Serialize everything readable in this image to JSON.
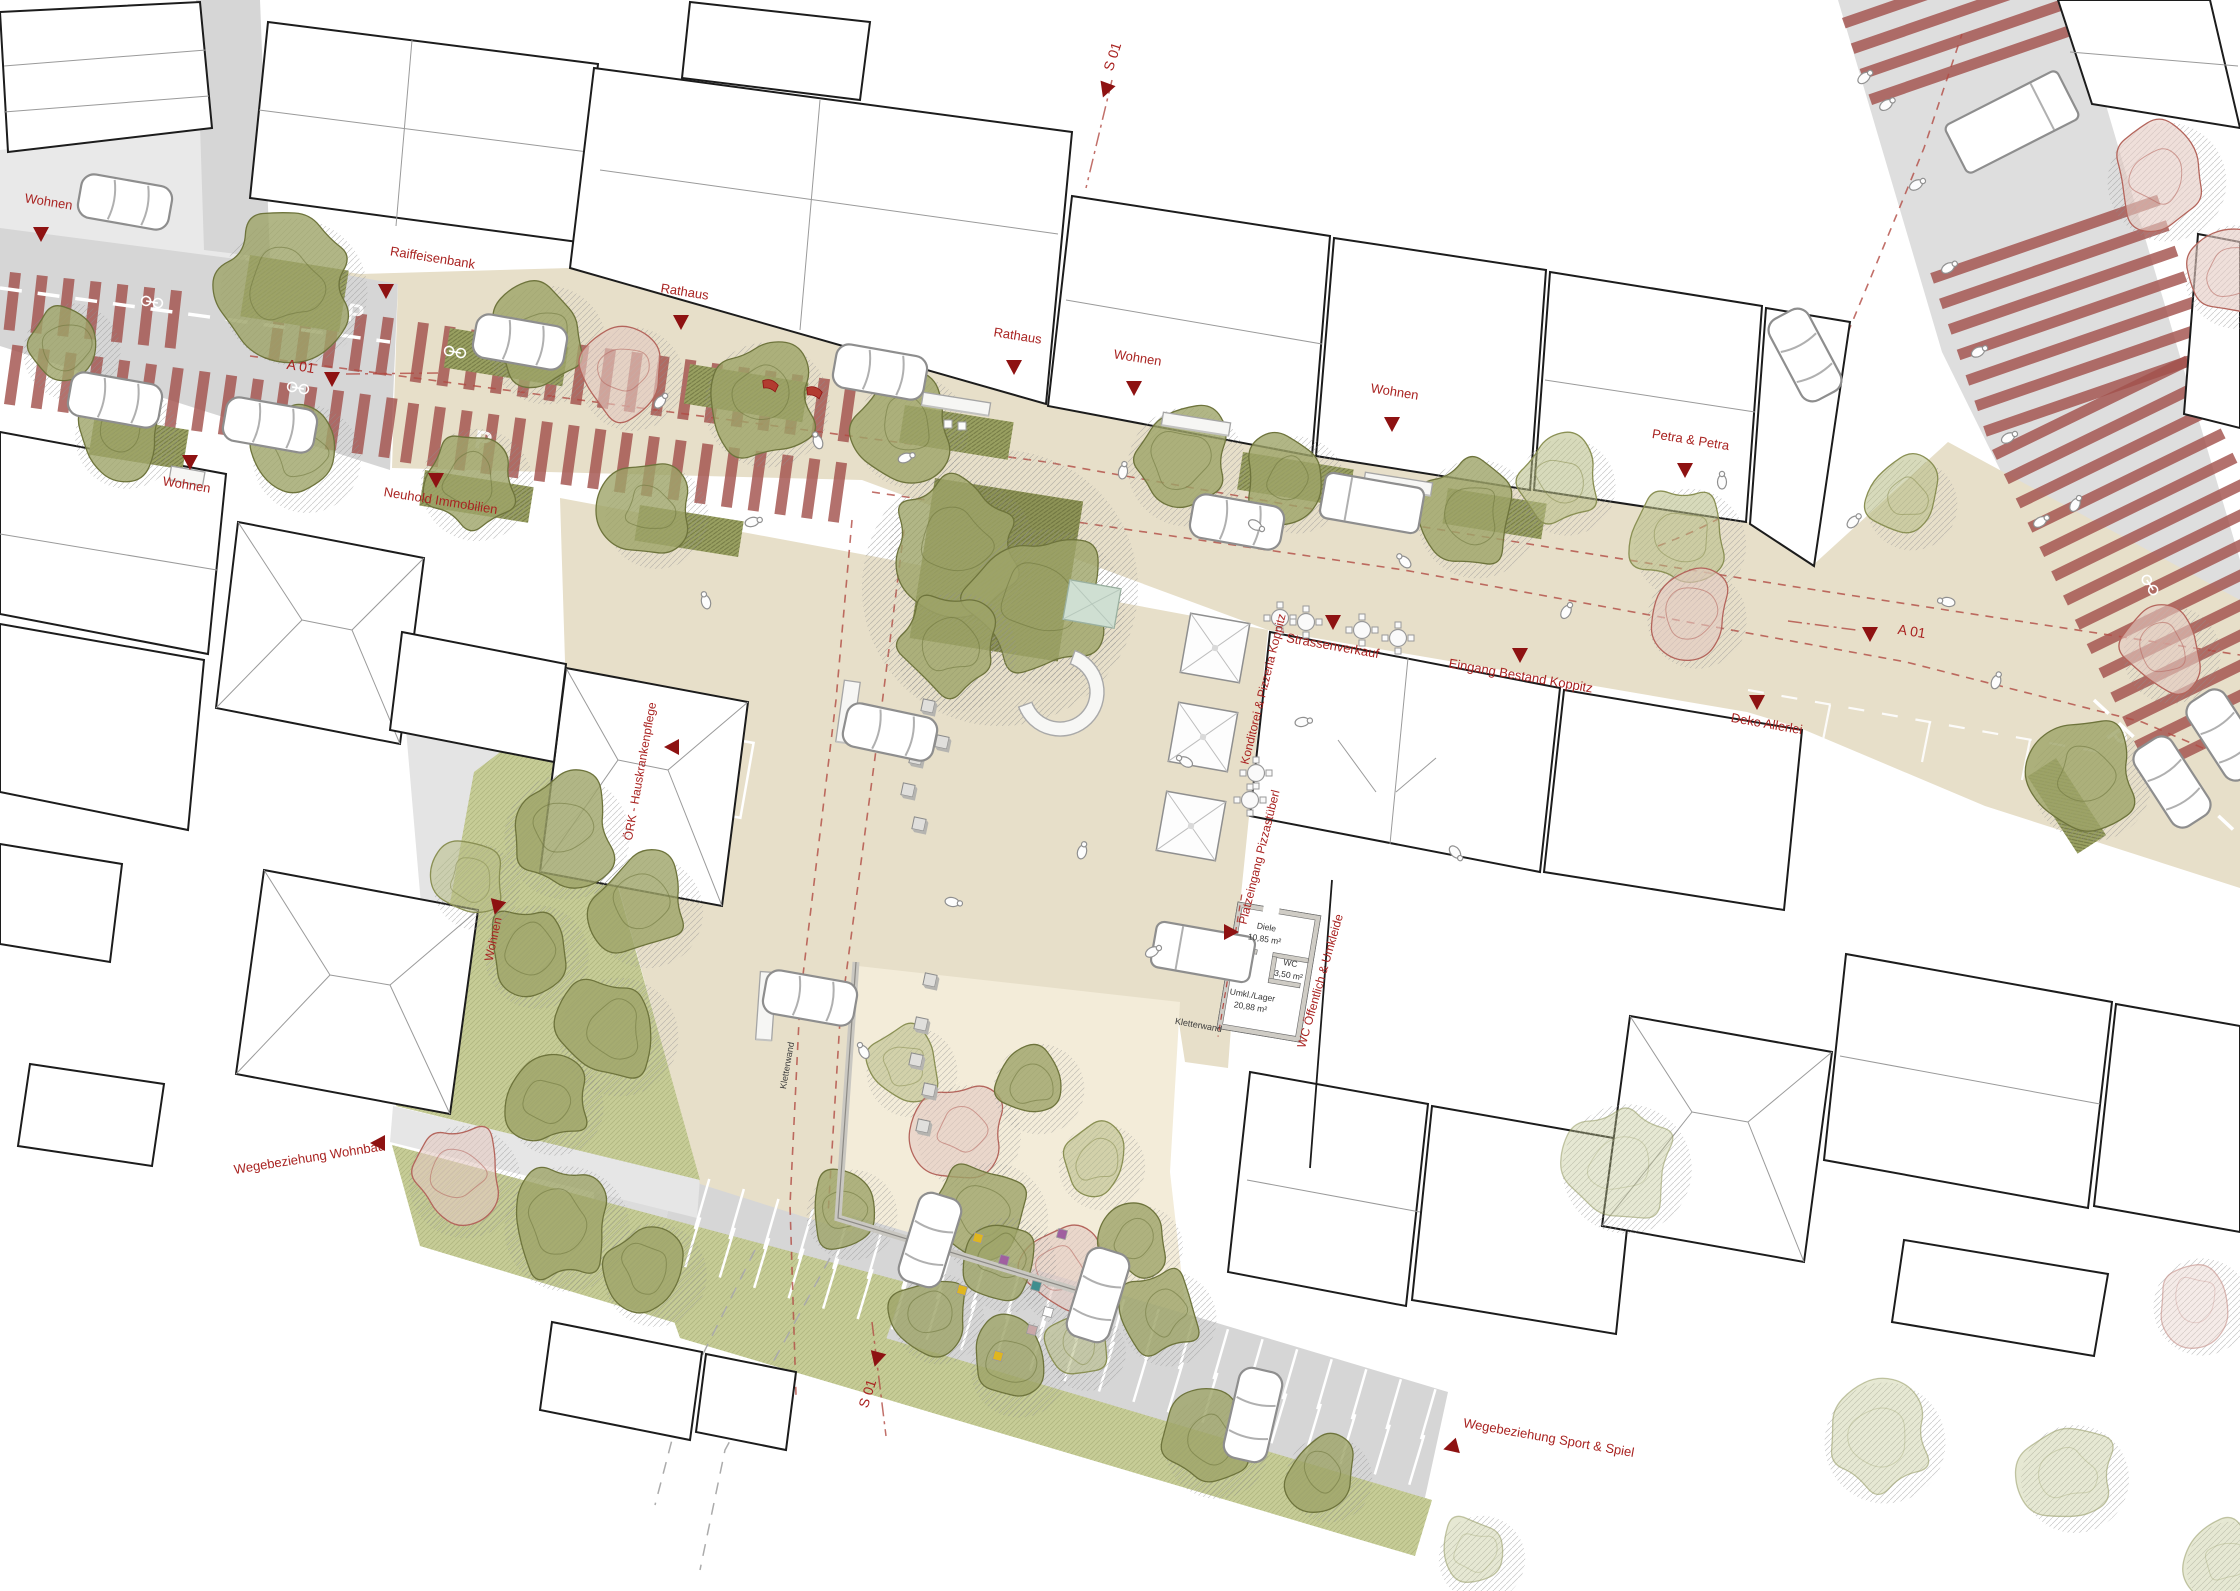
{
  "colors": {
    "background": "#ffffff",
    "plaza": "#e7dfc9",
    "street": "#d6d6d6",
    "street_light": "#e9e9e9",
    "building_fill": "#ffffff",
    "building_stroke": "#1c1c1c",
    "roof_line": "#9a9a9a",
    "stripe_red": "#a2524d",
    "label_red": "#a92321",
    "marker_red": "#8e1212",
    "guide_dash_red": "#b24b44",
    "tree_olive": "#6e743c",
    "tree_olive_light": "#8a9054",
    "tree_pink": "#b4655c",
    "lawn": "#c6cc96",
    "playground": "#f3ecd9",
    "wall_gray": "#c6c4be",
    "road_marking": "#ffffff",
    "black_label": "#3c3c3c"
  },
  "plan_labels": [
    {
      "id": "wohnen-top-left",
      "text": "Wohnen",
      "x": 48,
      "y": 206,
      "rot": 9,
      "size": 13,
      "color": "red",
      "marker": {
        "x": 41,
        "y": 233,
        "rot": 0
      }
    },
    {
      "id": "raiffeisenbank",
      "text": "Raiffeisenbank",
      "x": 432,
      "y": 262,
      "rot": 9,
      "size": 13,
      "color": "red",
      "marker": {
        "x": 386,
        "y": 290,
        "rot": 0
      }
    },
    {
      "id": "rathaus-west",
      "text": "Rathaus",
      "x": 684,
      "y": 296,
      "rot": 9,
      "size": 13,
      "color": "red",
      "marker": {
        "x": 681,
        "y": 321,
        "rot": 0
      }
    },
    {
      "id": "rathaus-east",
      "text": "Rathaus",
      "x": 1017,
      "y": 340,
      "rot": 9,
      "size": 13,
      "color": "red",
      "marker": {
        "x": 1014,
        "y": 366,
        "rot": 0
      }
    },
    {
      "id": "wohnen-north-1",
      "text": "Wohnen",
      "x": 1137,
      "y": 362,
      "rot": 9,
      "size": 13,
      "color": "red",
      "marker": {
        "x": 1134,
        "y": 387,
        "rot": 0
      }
    },
    {
      "id": "wohnen-north-2",
      "text": "Wohnen",
      "x": 1394,
      "y": 396,
      "rot": 9,
      "size": 13,
      "color": "red",
      "marker": {
        "x": 1392,
        "y": 423,
        "rot": 0
      }
    },
    {
      "id": "petra-petra",
      "text": "Petra & Petra",
      "x": 1690,
      "y": 444,
      "rot": 9,
      "size": 13,
      "color": "red",
      "marker": {
        "x": 1685,
        "y": 469,
        "rot": 0
      }
    },
    {
      "id": "a01-west",
      "text": "A 01",
      "x": 300,
      "y": 371,
      "rot": 9,
      "size": 14,
      "color": "red",
      "marker": {
        "x": 332,
        "y": 378,
        "rot": 0
      }
    },
    {
      "id": "wohnen-south",
      "text": "Wohnen",
      "x": 186,
      "y": 489,
      "rot": 9,
      "size": 13,
      "color": "red",
      "marker": {
        "x": 190,
        "y": 461,
        "rot": 0
      }
    },
    {
      "id": "neuhold",
      "text": "Neuhold Immobilien",
      "x": 440,
      "y": 505,
      "rot": 9,
      "size": 13,
      "color": "red",
      "marker": {
        "x": 436,
        "y": 479,
        "rot": 0
      }
    },
    {
      "id": "s01-north",
      "text": "S 01",
      "x": 1117,
      "y": 58,
      "rot": -72,
      "size": 14,
      "color": "red",
      "marker": {
        "x": 1106,
        "y": 89,
        "rot": 20
      }
    },
    {
      "id": "a01-east",
      "text": "A 01",
      "x": 1911,
      "y": 636,
      "rot": 9,
      "size": 14,
      "color": "red",
      "marker": {
        "x": 1870,
        "y": 633,
        "rot": 0
      }
    },
    {
      "id": "strassenverkauf",
      "text": "Strassenverkauf",
      "x": 1332,
      "y": 650,
      "rot": 10,
      "size": 13,
      "color": "red",
      "marker": {
        "x": 1333,
        "y": 621,
        "rot": 0
      }
    },
    {
      "id": "eingang-koppitz",
      "text": "Eingang Bestand Koppitz",
      "x": 1520,
      "y": 680,
      "rot": 10,
      "size": 13,
      "color": "red",
      "marker": {
        "x": 1520,
        "y": 654,
        "rot": 0
      }
    },
    {
      "id": "deko-allerlei",
      "text": "Deko Allerlei",
      "x": 1766,
      "y": 728,
      "rot": 10,
      "size": 13,
      "color": "red",
      "marker": {
        "x": 1757,
        "y": 701,
        "rot": 0
      }
    },
    {
      "id": "konditorei",
      "text": "Konditorei & Pizzeria Koppitz",
      "x": 1267,
      "y": 690,
      "rot": -76,
      "size": 12,
      "color": "red",
      "marker": null
    },
    {
      "id": "platzeingang",
      "text": "Platzeingang Pizzastüberl",
      "x": 1263,
      "y": 858,
      "rot": -76,
      "size": 12,
      "color": "red",
      "marker": null
    },
    {
      "id": "drk",
      "text": "ÖRK - Hauskrankenpflege",
      "x": 644,
      "y": 772,
      "rot": -80,
      "size": 12,
      "color": "red",
      "marker": {
        "x": 673,
        "y": 747,
        "rot": 90
      }
    },
    {
      "id": "wohnen-west-vert",
      "text": "Wohnen",
      "x": 497,
      "y": 940,
      "rot": -78,
      "size": 12,
      "color": "red",
      "marker": {
        "x": 497,
        "y": 906,
        "rot": 15
      }
    },
    {
      "id": "wegebeziehung-wohnbau",
      "text": "Wegebeziehung Wohnbau",
      "x": 310,
      "y": 1162,
      "rot": -9,
      "size": 13,
      "color": "red",
      "marker": {
        "x": 379,
        "y": 1143,
        "rot": 90
      }
    },
    {
      "id": "s01-south",
      "text": "S 01",
      "x": 872,
      "y": 1395,
      "rot": -72,
      "size": 14,
      "color": "red",
      "marker": {
        "x": 877,
        "y": 1358,
        "rot": 15
      }
    },
    {
      "id": "sport-spiel",
      "text": "Wegebeziehung Sport & Spiel",
      "x": 1548,
      "y": 1442,
      "rot": 10,
      "size": 13,
      "color": "red",
      "marker": {
        "x": 1452,
        "y": 1447,
        "rot": 75
      }
    },
    {
      "id": "kletterwand-east",
      "text": "Kletterwand",
      "x": 1198,
      "y": 1028,
      "rot": 10,
      "size": 9,
      "color": "black",
      "marker": null
    },
    {
      "id": "kletterwand-west",
      "text": "Kletterwand",
      "x": 790,
      "y": 1066,
      "rot": -80,
      "size": 9,
      "color": "black",
      "marker": null
    },
    {
      "id": "wc-oeffentlich",
      "text": "WC Öffentlich & Umkleide",
      "x": 1324,
      "y": 982,
      "rot": -74,
      "size": 12,
      "color": "red",
      "marker": {
        "x": 1230,
        "y": 932,
        "rot": -90
      }
    }
  ],
  "room_labels": [
    {
      "name": "Diele",
      "area": "10,85 m²",
      "x": 1266,
      "y": 930,
      "rot": 9.5
    },
    {
      "name": "WC",
      "area": "3,50 m²",
      "x": 1290,
      "y": 966,
      "rot": 9.5
    },
    {
      "name": "Umkl./Lager",
      "area": "20,88 m²",
      "x": 1252,
      "y": 998,
      "rot": 9.5
    }
  ],
  "parking_letters": [
    {
      "text": "P",
      "x": 354,
      "y": 322,
      "rot": 9
    },
    {
      "text": "P",
      "x": 482,
      "y": 449,
      "rot": 9
    },
    {
      "text": "P",
      "x": 1458,
      "y": 480,
      "rot": 9
    },
    {
      "text": "P",
      "x": 2110,
      "y": 742,
      "rot": 58
    }
  ],
  "symbols": {
    "tree-icon": "irregular canopy blob with hatched shadow circle",
    "blossom-tree-icon": "pink outlined canopy",
    "planter-icon": "olive hatched rectangle",
    "car-icon": "white rounded rectangle with windshield lines",
    "van-icon": "long white rounded rectangle",
    "truck-icon": "white box truck",
    "person-icon": "small white figure seen from above",
    "bench-icon": "white slat rectangle",
    "seat-cube-icon": "small gray cube",
    "market-stall-icon": "white square canopy with X diagonals",
    "cafe-table-icon": "round table with four chairs",
    "tree-bench-icon": "C-shaped circular bench",
    "wheelchair-icon": "white accessible-parking figure",
    "triangle-marker-icon": "▼ dark red entrance/section marker",
    "parking-letter-icon": "white P road marking"
  }
}
